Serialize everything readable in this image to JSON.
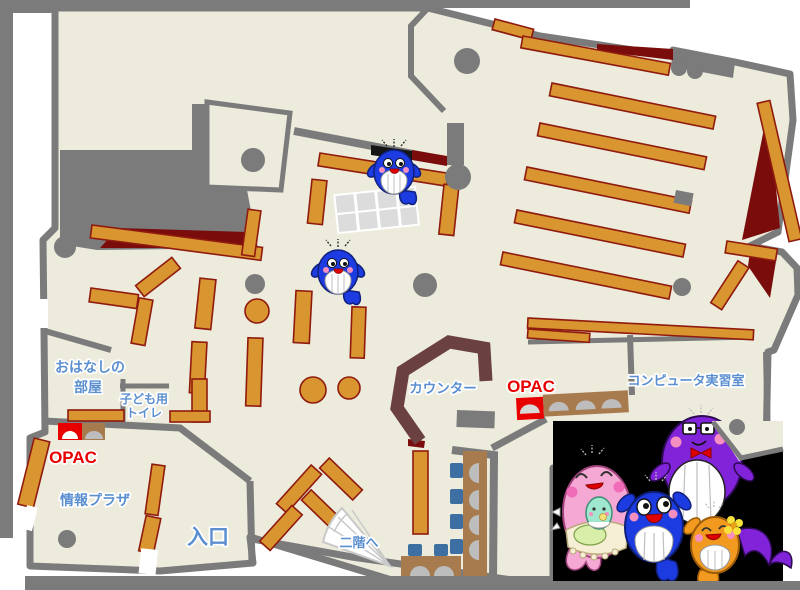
{
  "page": {
    "title": "図書館 館内マップ（1階）"
  },
  "labels": {
    "storytelling_room_line1": "おはなしの",
    "storytelling_room_line2": "部屋",
    "kids_toilet_line1": "子ども用",
    "kids_toilet_line2": "トイレ",
    "opac_left": "OPAC",
    "opac_right": "OPAC",
    "info_plaza": "情報プラザ",
    "entrance": "入口",
    "to_second_floor": "二階へ",
    "counter": "カウンター",
    "computer_room": "コンピュータ実習室"
  },
  "colors": {
    "floor": "#ECEBDC",
    "wall": "#7B7B7B",
    "shelf": "#D9952F",
    "shelf_border": "#8F1A0F",
    "dark_red": "#7A0C0C",
    "counter_brown": "#6B4040",
    "furniture_brown": "#A87B4F",
    "chair_blue": "#3E6FA3",
    "monitor_gray": "#BDBDBD",
    "label_blue": "#5B8FD0",
    "opac_red": "#E80000",
    "table_gray": "#DCDCDC",
    "mascot_pink": "#F4A8D3",
    "mascot_blue": "#1C3BE0",
    "mascot_purple": "#8123D8",
    "mascot_orange": "#F2991F",
    "mascot_mint": "#9FE7CF"
  },
  "icons": {
    "whale_on_map_1": "blue-whale-mascot",
    "whale_on_map_2": "blue-whale-mascot",
    "mascot_family": [
      "pink-whale-mother",
      "blue-whale-child",
      "purple-whale-father",
      "orange-whale-child"
    ],
    "opac_terminal": "terminal-with-monitor",
    "stairs": "stairs-fan-to-2f"
  }
}
